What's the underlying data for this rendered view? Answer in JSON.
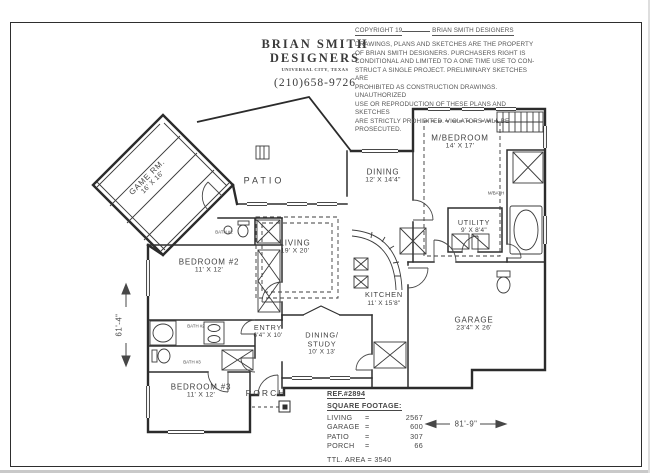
{
  "title_block": {
    "name_line1": "BRIAN SMITH",
    "name_line2": "DESIGNERS",
    "tagline": "UNIVERSAL CITY, TEXAS",
    "phone": "(210)658-9726"
  },
  "copyright": {
    "label": "COPYRIGHT 19",
    "owner": "BRIAN SMITH DESIGNERS",
    "lines": [
      "DRAWINGS, PLANS AND SKETCHES ARE THE PROPERTY",
      "OF BRIAN SMITH DESIGNERS.  PURCHASERS RIGHT IS",
      "CONDITIONAL AND LIMITED TO A ONE TIME USE TO CON-",
      "STRUCT A SINGLE PROJECT.  PRELIMINARY SKETCHES ARE",
      "PROHIBITED AS CONSTRUCTION DRAWINGS.  UNAUTHORIZED",
      "USE OR REPRODUCTION OF THESE PLANS AND SKETCHES",
      "ARE STRICTLY PROHIBITED.  VIOLATORS WILL BE PROSECUTED."
    ]
  },
  "rooms": {
    "game": {
      "label": "GAME RM.",
      "dims": "16' X 16'"
    },
    "patio": {
      "label": "PATIO"
    },
    "dining": {
      "label": "DINING",
      "dims": "12' X 14'4\""
    },
    "master_bedroom": {
      "label": "M/BEDROOM",
      "dims": "14' X 17'"
    },
    "master_bath": {
      "label": "M/BATH"
    },
    "utility": {
      "label": "UTILITY",
      "dims": "9' X 8'4\""
    },
    "living": {
      "label": "LIVING",
      "dims": "19' X 20'"
    },
    "kitchen": {
      "label": "KITCHEN",
      "dims": "11' X 15'8\""
    },
    "garage": {
      "label": "GARAGE",
      "dims": "23'4\" X 26'"
    },
    "bedroom2": {
      "label": "BEDROOM #2",
      "dims": "11' X 12'"
    },
    "bedroom3": {
      "label": "BEDROOM #3",
      "dims": "11' X 12'"
    },
    "entry": {
      "label": "ENTRY",
      "dims": "6'4\" X 10'"
    },
    "dining_study": {
      "label1": "DINING/",
      "label2": "STUDY",
      "dims": "10' X 13'"
    },
    "porch": {
      "label": "PORCH"
    },
    "hall_bath": {
      "label": "BATH #2"
    },
    "bath2": {
      "label": "BATH #2"
    },
    "bath3": {
      "label": "BATH #3"
    }
  },
  "dimensions": {
    "left_overall": "61'-4\"",
    "bottom_overall": "81'-9\""
  },
  "summary": {
    "ref": "REF.#2894",
    "heading": "SQUARE FOOTAGE:",
    "rows": [
      {
        "label": "LIVING",
        "eq": "=",
        "value": "2567"
      },
      {
        "label": "GARAGE",
        "eq": "=",
        "value": "600"
      },
      {
        "label": "PATIO",
        "eq": "=",
        "value": "307"
      },
      {
        "label": "PORCH",
        "eq": "=",
        "value": "66"
      }
    ],
    "total_label": "TTL. AREA =",
    "total_value": "3540"
  }
}
